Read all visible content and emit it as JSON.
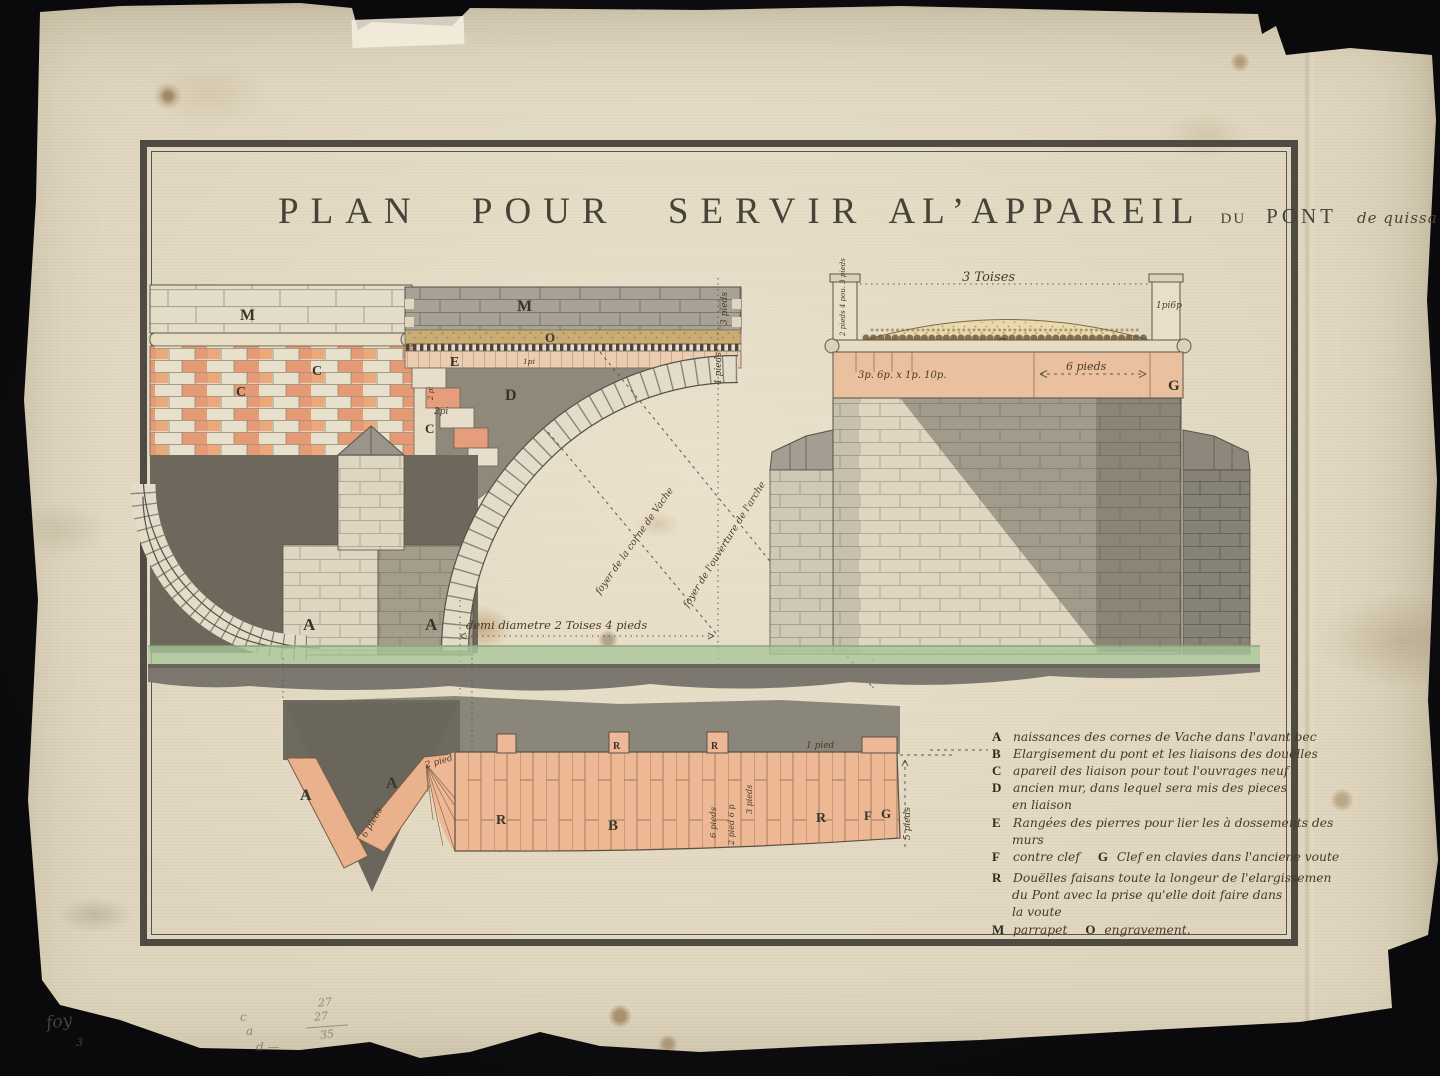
{
  "artwork": {
    "title": {
      "main": "PLAN POUR SERVIR",
      "appareil": "ALʼAPPAREIL",
      "du": "DU",
      "pont": "PONT",
      "place": "de quissa"
    }
  },
  "left_drawing": {
    "labels": {
      "m_left": "M",
      "m_right": "M",
      "c1": "C",
      "c2": "C",
      "step_c": "C",
      "o": "O",
      "e": "E",
      "e_dim": "1pi",
      "d": "D",
      "step_dim": "2pi",
      "step_dim2": "2 pi",
      "a_left": "A",
      "a_right": "A"
    },
    "dims": {
      "v1": "3 pieds",
      "v2": "4 pieds",
      "diameter": "demi diametre  2 Toises 4 pieds"
    },
    "rays": {
      "ray1": "foyer de la corne de Vache",
      "ray2": "foyer de l'ouverture de l'arche"
    }
  },
  "right_drawing": {
    "labels": {
      "o": "O",
      "g": "G"
    },
    "dims": {
      "toises": "3 Toises",
      "pilaster_left": "2 pieds 4 pou. 3 pieds",
      "pilaster_right": "1pi6p",
      "band": "3p. 6p. x 1p. 10p.",
      "six_pieds": "6 pieds"
    }
  },
  "plan_strip": {
    "labels": {
      "a_left": "A",
      "a_right": "A",
      "r1": "R",
      "b": "B",
      "r2": "R",
      "f": "F",
      "g": "G",
      "r_tab1": "R",
      "r_tab2": "R"
    },
    "dims": {
      "two_pied": "2 pied",
      "six_slope": "6 pieds",
      "one_pied": "1 pied",
      "six": "6 pieds",
      "two_six": "2 pied 6 p",
      "three": "3 pieds",
      "five": "5 pieds"
    }
  },
  "legend": {
    "items": [
      {
        "key": "A",
        "text": "naissances des cornes de Vache dans l'avant bec"
      },
      {
        "key": "B",
        "text": "Elargisement du pont et les liaisons des douëlles"
      },
      {
        "key": "C",
        "text": "apareil des liaison pour tout l'ouvrages neuf"
      },
      {
        "key": "D",
        "text": "ancien mur, dans lequel sera mis des pieces"
      },
      {
        "key": "",
        "text": "en liaison"
      },
      {
        "key": "E",
        "text": "Rangées des pierres pour lier les à dossements des"
      },
      {
        "key": "",
        "text": "murs"
      },
      {
        "key": "F",
        "text": "contre clef"
      },
      {
        "key": "G",
        "text": "Clef en clavies dans l'anciene voute"
      },
      {
        "key": "R",
        "text": "Douëlles faisans toute la longeur de l'elargissemen"
      },
      {
        "key": "",
        "text": "du Pont avec la prise qu'elle doit faire dans"
      },
      {
        "key": "",
        "text": "la voute"
      },
      {
        "key": "M",
        "text": "parrapet"
      },
      {
        "key": "O",
        "text": "engravement."
      }
    ]
  },
  "margin": {
    "foy": "foy",
    "num": "3",
    "c": "c",
    "a": "a",
    "d": "d —",
    "p1": "27",
    "p2": "27",
    "p3": "35"
  }
}
